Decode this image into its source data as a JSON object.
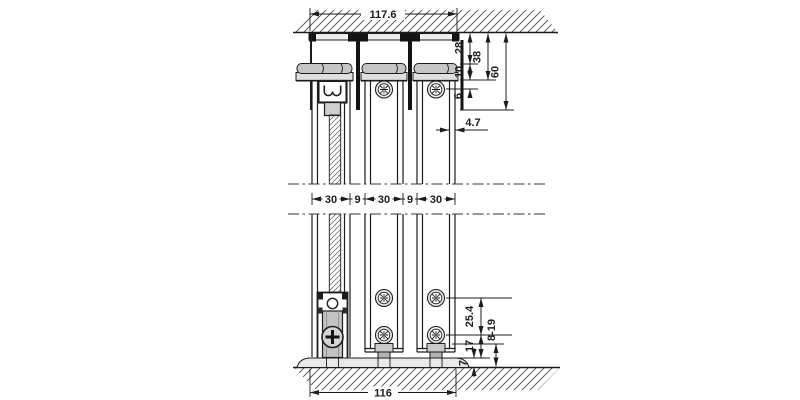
{
  "drawing": {
    "type": "sliding-door-system-cross-section",
    "dimensions": {
      "top_width": "117.6",
      "depth_to_cap_top": "28",
      "depth_to_cap_bottom": "38",
      "depth_total": "60",
      "cap_height": "10",
      "screw_offset": "6",
      "wall_thickness": "4.7",
      "middle": [
        "30",
        "9",
        "30",
        "9",
        "30"
      ],
      "screw_spacing": "25.4",
      "bottom_screw_offset": "17",
      "floor_clearance": "8-19",
      "floor_track_height": "7",
      "bottom_width": "116"
    },
    "colors": {
      "line": "#1c1c1c",
      "cap_fill": "#c6c6c6",
      "hardware_fill": "#b8b8b8",
      "light_fill": "#ececec",
      "background": "#ffffff"
    }
  }
}
